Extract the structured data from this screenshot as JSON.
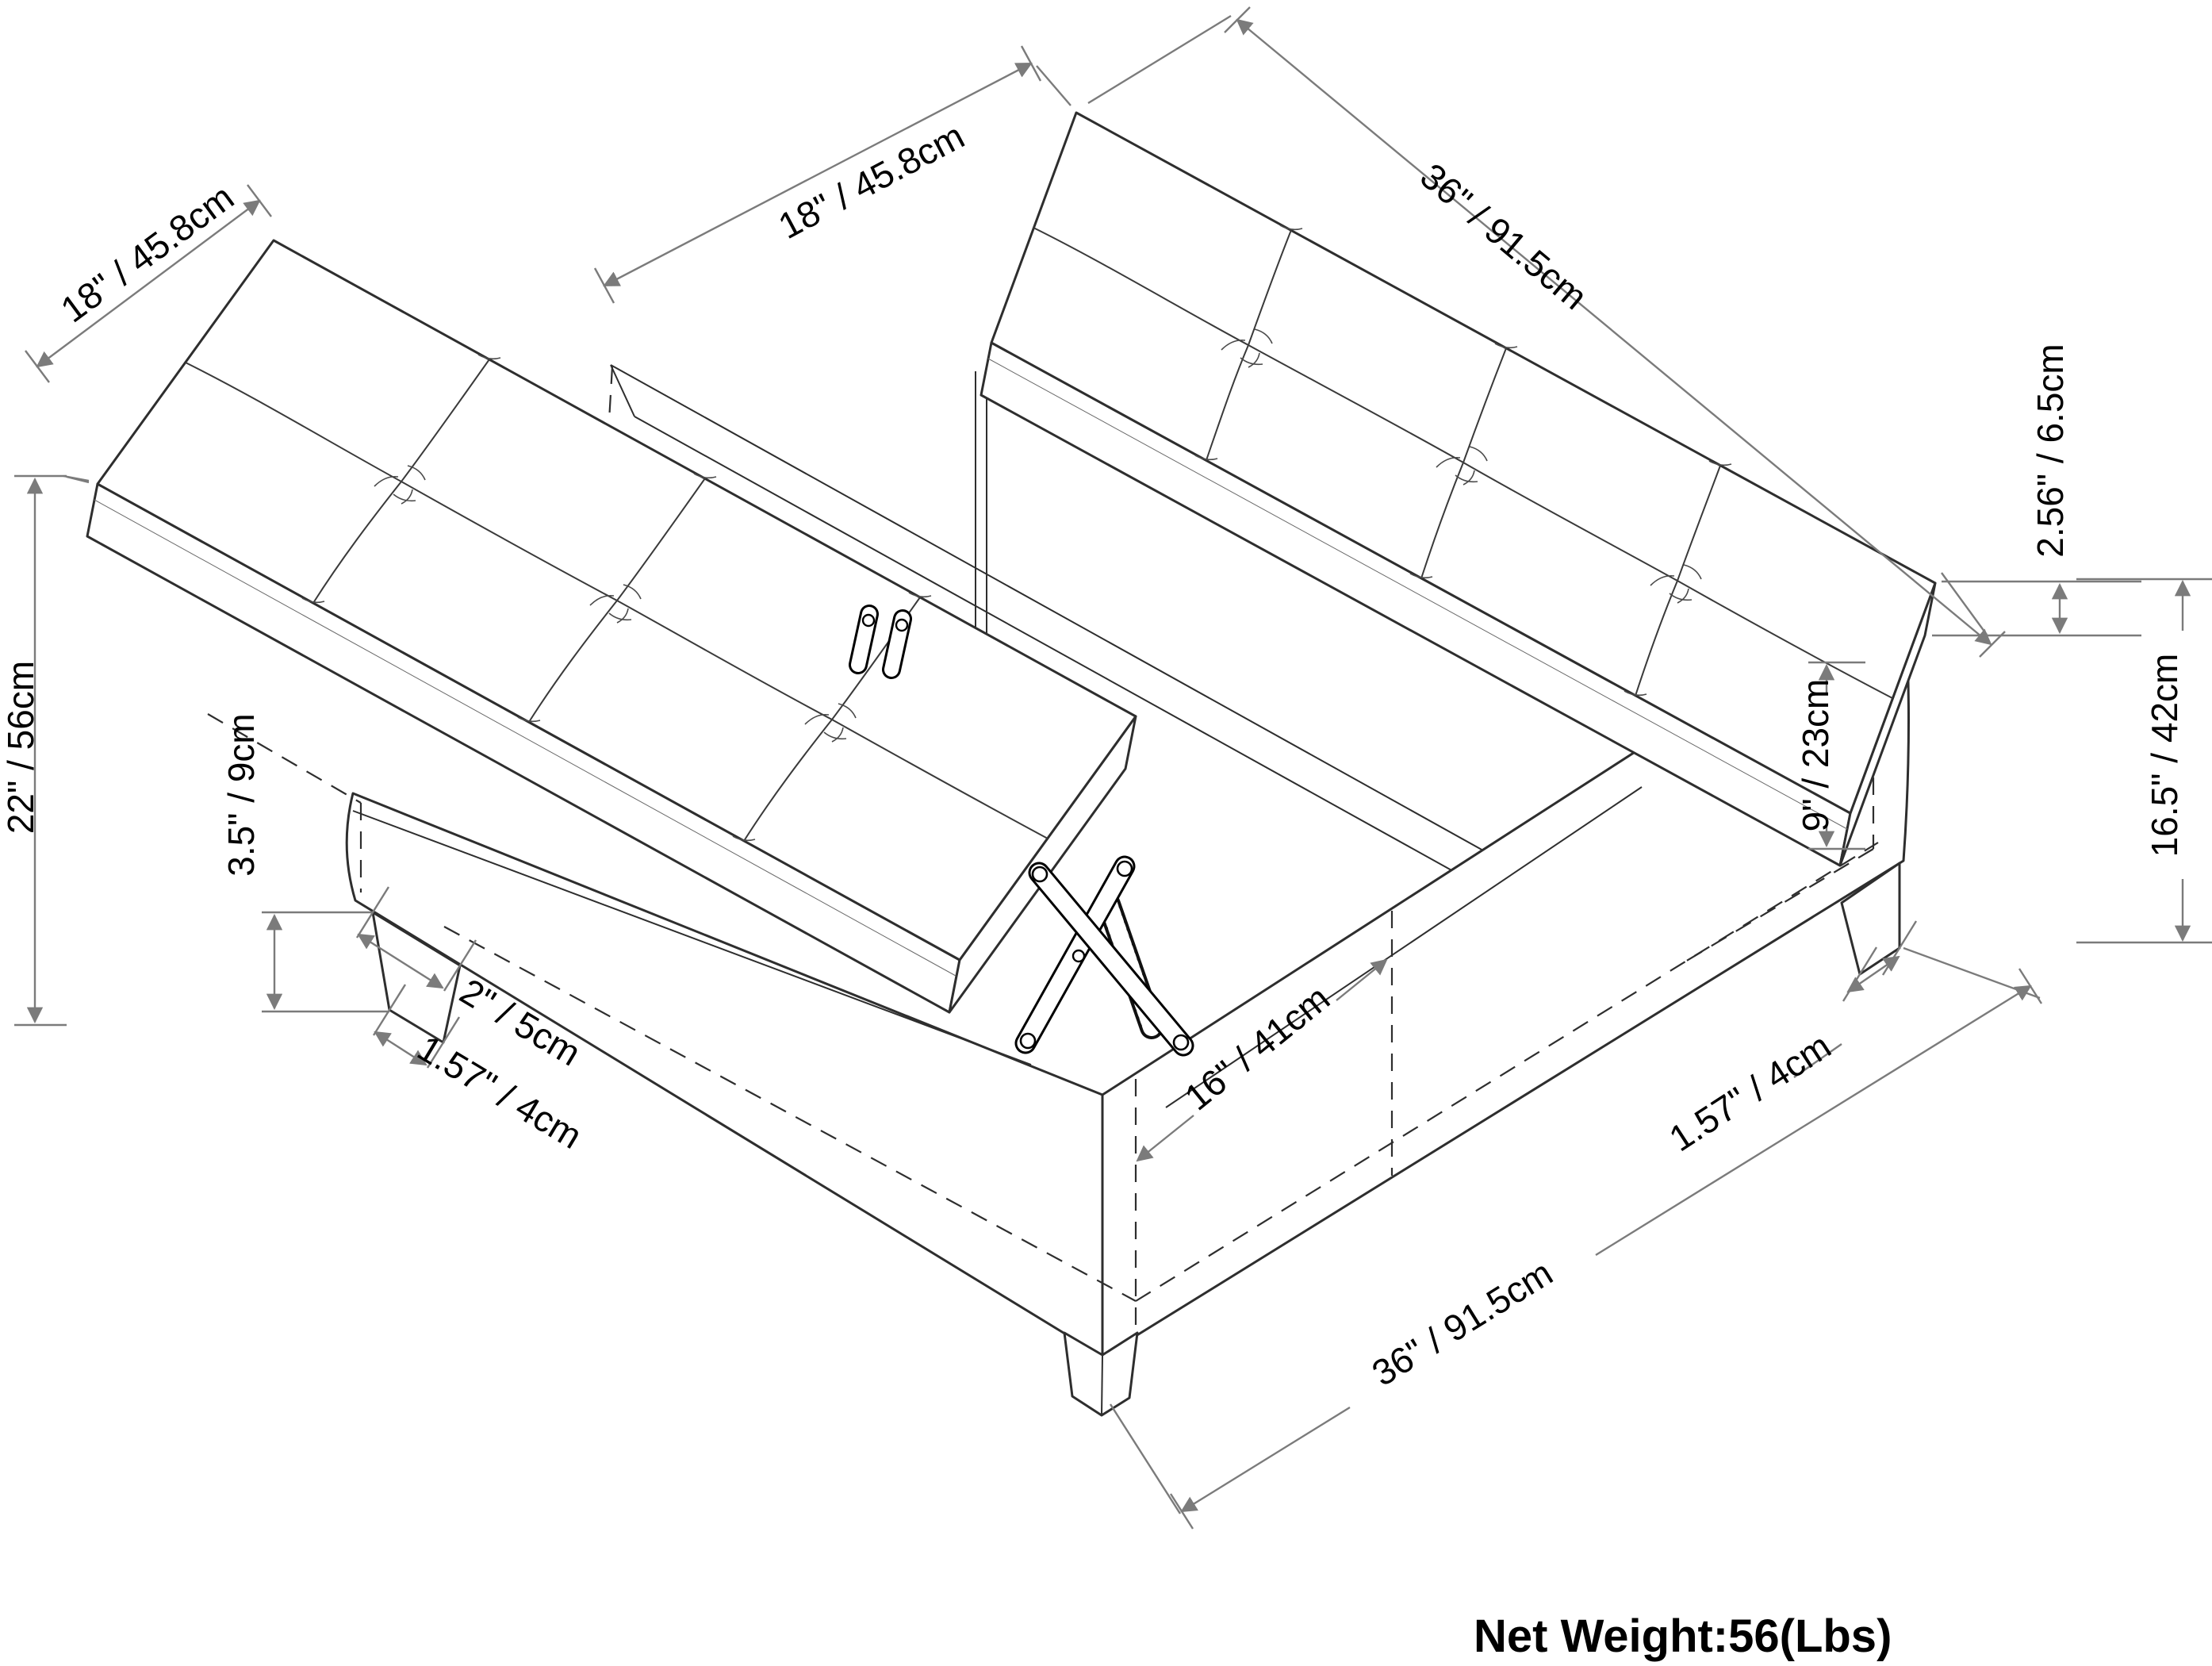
{
  "diagram": {
    "subject": "lift-top square storage ottoman with tufted cushions - dimension drawing",
    "net_weight_label": "Net Weight:56(Lbs)",
    "dims": {
      "left_lid_width": "18\" / 45.8cm",
      "right_lid_width": "18\" / 45.8cm",
      "right_lid_length": "36\" / 91.5cm",
      "cushion_thickness": "2.56\" / 6.5cm",
      "total_height": "22\" / 56cm",
      "leg_height": "3.5\" / 9cm",
      "storage_depth": "9\" / 23cm",
      "base_height": "16.5\" / 42cm",
      "leg_top_width": "2\" / 5cm",
      "leg_bottom_width_left": "1.57\" / 4cm",
      "storage_opening_width": "16\" / 41cm",
      "leg_bottom_width_right": "1.57\" / 4cm",
      "base_length": "36\" / 91.5cm"
    }
  }
}
